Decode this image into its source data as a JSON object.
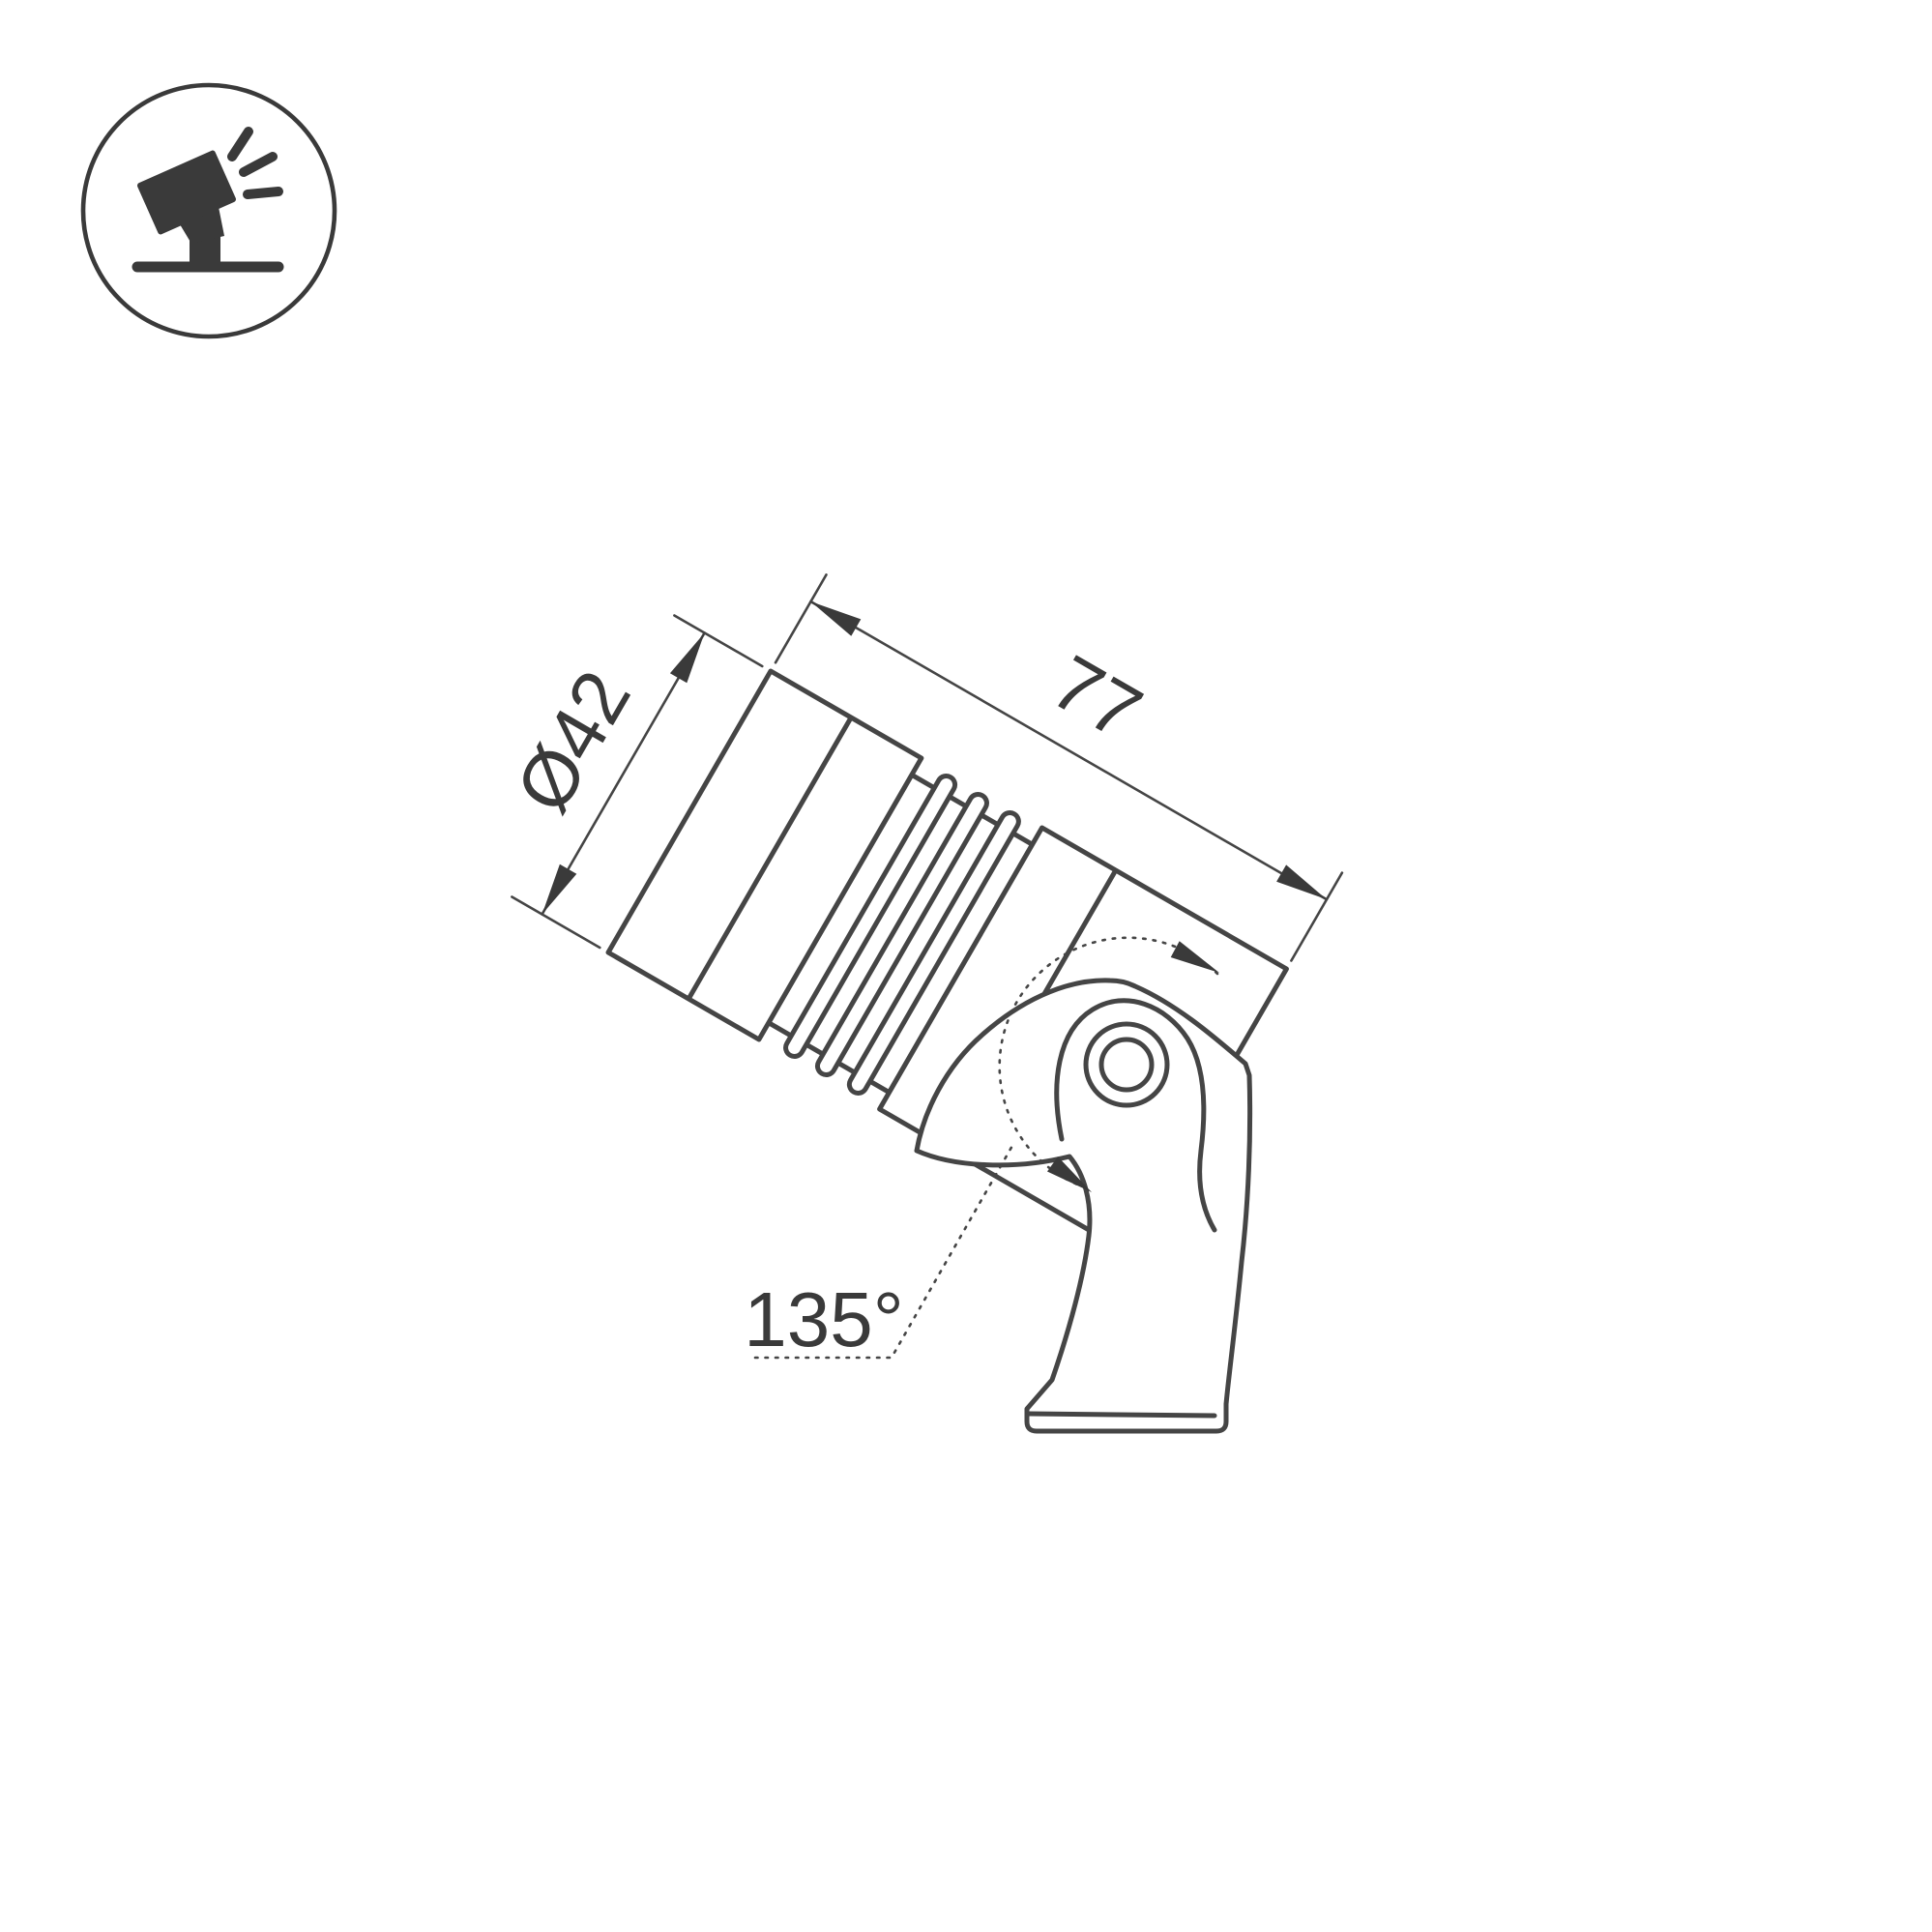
{
  "drawing": {
    "kind": "technical-dimension-drawing",
    "subject": "tilted-spotlight-with-mounting-bracket"
  },
  "labels": {
    "diameter": "Ø42",
    "length": "77",
    "angle": "135°"
  },
  "icon": {
    "name": "tilted-spotlight-on-stand-icon"
  },
  "colors": {
    "line": "#454545",
    "dark": "#3a3a3a",
    "text": "#3a3a3a",
    "background": "#ffffff"
  }
}
